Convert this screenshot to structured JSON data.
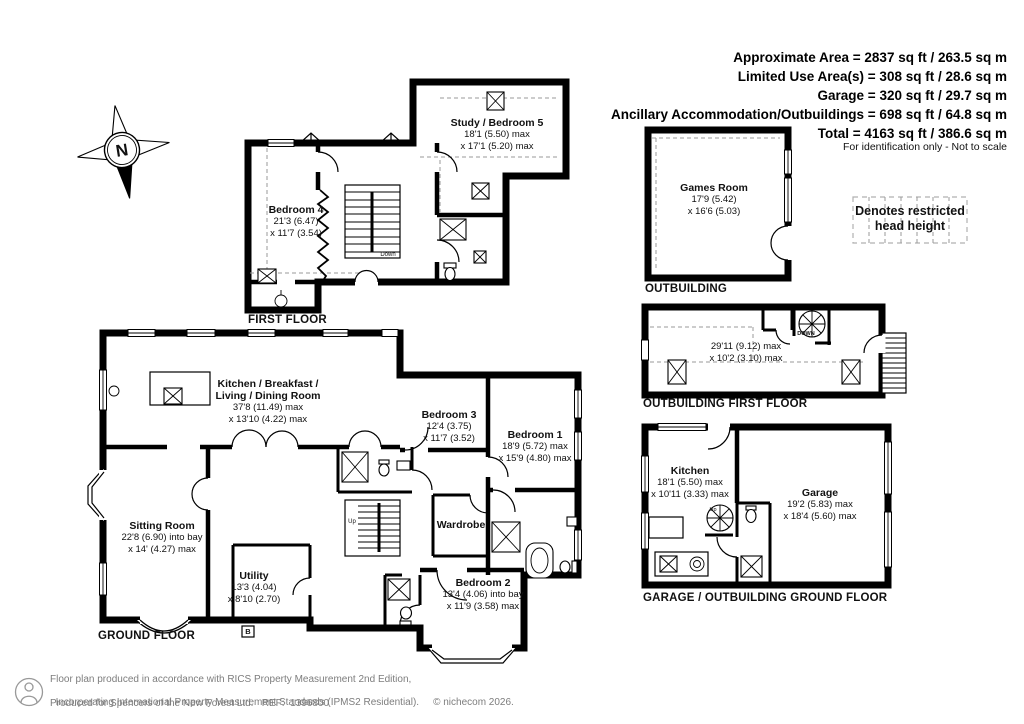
{
  "summary": {
    "lines": [
      "Approximate Area = 2837 sq ft / 263.5 sq m",
      "Limited Use Area(s) = 308 sq ft / 28.6 sq m",
      "Garage = 320 sq ft / 29.7 sq m",
      "Ancillary Accommodation/Outbuildings = 698 sq ft / 64.8 sq m",
      "Total = 4163 sq ft / 386.6 sq m"
    ],
    "disclaimer": "For identification only - Not to scale"
  },
  "compass": {
    "north_label": "N"
  },
  "legend": {
    "line1": "Denotes restricted",
    "line2": "head height"
  },
  "first_floor": {
    "title": "FIRST FLOOR",
    "stairs_label": "Down",
    "rooms": {
      "study_bedroom5": {
        "name": "Study / Bedroom 5",
        "dims": [
          "18'1 (5.50) max",
          "x 17'1 (5.20)  max"
        ]
      },
      "bedroom4": {
        "name": "Bedroom 4",
        "dims": [
          "21'3 (6.47)",
          "x 11'7 (3.54)"
        ]
      }
    }
  },
  "ground_floor": {
    "title": "GROUND FLOOR",
    "stairs_label": "Up",
    "boiler_label": "B",
    "rooms": {
      "kitchen_living": {
        "name_line1": "Kitchen / Breakfast /",
        "name_line2": "Living / Dining Room",
        "dims": [
          "37'8 (11.49) max",
          "x 13'10 (4.22) max"
        ]
      },
      "bedroom3": {
        "name": "Bedroom 3",
        "dims": [
          "12'4 (3.75)",
          "x 11'7 (3.52)"
        ]
      },
      "bedroom1": {
        "name": "Bedroom 1",
        "dims": [
          "18'9 (5.72) max",
          "x 15'9 (4.80) max"
        ]
      },
      "sitting_room": {
        "name": "Sitting Room",
        "dims": [
          "22'8 (6.90) into bay",
          "x 14' (4.27) max"
        ]
      },
      "utility": {
        "name": "Utility",
        "dims": [
          "13'3 (4.04)",
          "x 8'10 (2.70)"
        ]
      },
      "wardrobe": {
        "name": "Wardrobe"
      },
      "bedroom2": {
        "name": "Bedroom 2",
        "dims": [
          "13'4 (4.06) into bay",
          "x 11'9 (3.58) max"
        ]
      }
    }
  },
  "outbuilding": {
    "title": "OUTBUILDING",
    "rooms": {
      "games_room": {
        "name": "Games Room",
        "dims": [
          "17'9 (5.42)",
          "x 16'6 (5.03)"
        ]
      }
    }
  },
  "outbuilding_first_floor": {
    "title": "OUTBUILDING FIRST FLOOR",
    "stairs_label": "DOWN",
    "dims": [
      "29'11 (9.12) max",
      "x 10'2 (3.10) max"
    ]
  },
  "garage_outbuilding_ground_floor": {
    "title": "GARAGE / OUTBUILDING GROUND FLOOR",
    "stairs_label": "Up",
    "rooms": {
      "kitchen": {
        "name": "Kitchen",
        "dims": [
          "18'1 (5.50) max",
          "x 10'11 (3.33) max"
        ]
      },
      "garage": {
        "name": "Garage",
        "dims": [
          "19'2 (5.83) max",
          "x 18'4 (5.60) max"
        ]
      }
    }
  },
  "footer": {
    "line1": "Floor plan produced in accordance with RICS Property Measurement 2nd Edition,",
    "line2": "Incorporating International Property Measurement Standards (IPMS2 Residential).",
    "copyright": "© nichecom 2026.",
    "line3": "Produced for Spencers of the New Forest Ltd.   REF:  1396800"
  },
  "colors": {
    "wall": "#000000",
    "dashed_line": "#9a9a9a",
    "footer_text": "#7d7d7d",
    "background": "#ffffff"
  }
}
